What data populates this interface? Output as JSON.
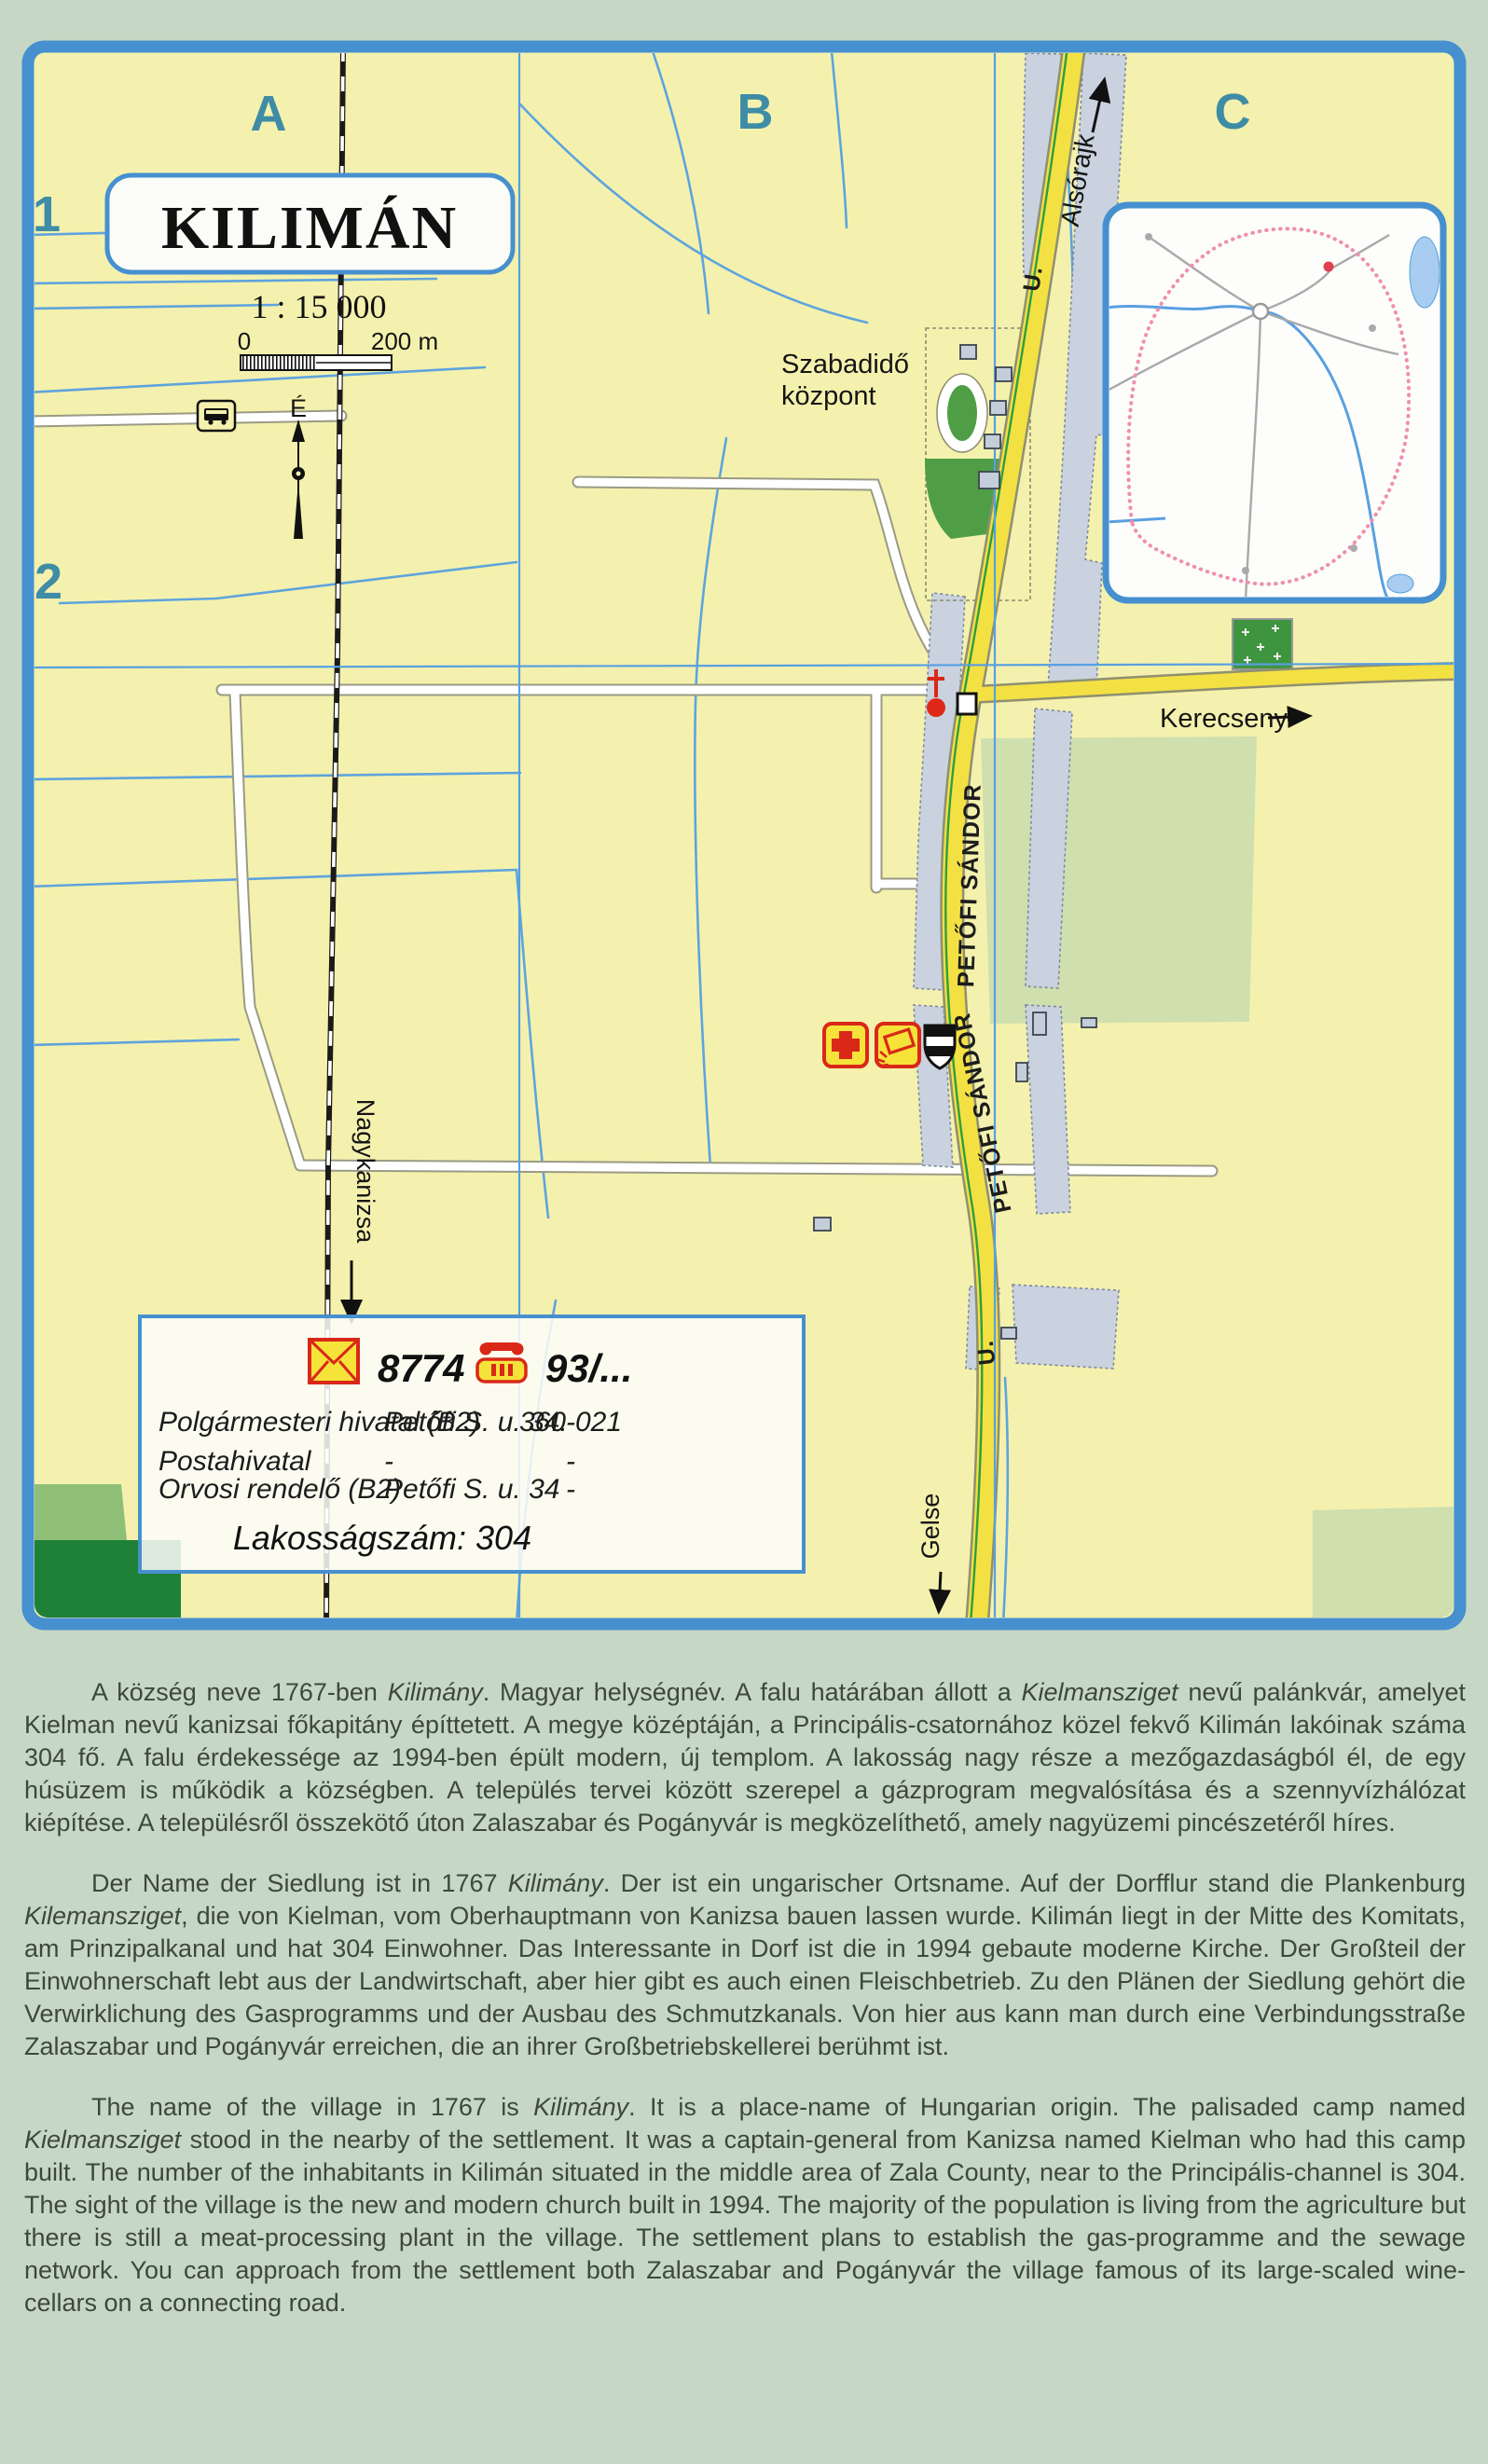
{
  "map": {
    "title": "KILIMÁN",
    "scale_text": "1 : 15 000",
    "scale_bar": {
      "start": "0",
      "end": "200 m"
    },
    "north_label": "É",
    "grid_cols": [
      "A",
      "B",
      "C"
    ],
    "grid_rows": [
      "1",
      "2"
    ],
    "labels": {
      "alsorajk": "Alsórajk",
      "kerecseny": "Kerecseny",
      "gelse": "Gelse",
      "nagykanizsa": "Nagykanizsa",
      "szabadido_line1": "Szabadidő",
      "szabadido_line2": "központ",
      "street": "PETŐFI SÁNDOR",
      "street_suffix": "U."
    },
    "icons": {
      "church": "church-icon",
      "medical": "red-cross-icon",
      "post": "posthorn-icon",
      "municipal": "shield-icon",
      "station": "bus-stop-icon",
      "cemetery": "cemetery-crosses",
      "north": "compass-needle-icon"
    }
  },
  "legend": {
    "postal_code": "8774",
    "phone_prefix": "93/...",
    "rows": [
      {
        "name": "Polgármesteri hivatal (B2)",
        "address": "Petőfi S. u. 34.",
        "phone": "360-021"
      },
      {
        "name": "Postahivatal",
        "address": "-",
        "phone": "-"
      },
      {
        "name": "Orvosi rendelő (B2)",
        "address": "Petőfi S. u. 34",
        "phone": "-"
      }
    ],
    "population_label": "Lakosságszám: 304"
  },
  "description": {
    "paragraphs": [
      {
        "lang": "hu",
        "segments": [
          {
            "t": "A község neve 1767-ben "
          },
          {
            "t": "Kilimány",
            "i": true
          },
          {
            "t": ". Magyar helységnév. A falu határában állott a "
          },
          {
            "t": "Kielmansziget",
            "i": true
          },
          {
            "t": " nevű palánkvár, amelyet Kielman nevű kanizsai főkapitány építtetett. A megye középtáján, a Principális-csatornához közel fekvő Kilimán lakóinak száma 304 fő.  A falu érdekessége az 1994-ben épült modern, új templom. A lakosság nagy része a mezőgazdaságból él, de egy húsüzem is működik a községben. A település tervei között szerepel a gázprogram megvalósítása és a szennyvízhálózat kiépítése. A településről összekötő úton Zalaszabar és  Pogányvár is megközelíthető, amely nagyüzemi pincészetéről híres."
          }
        ]
      },
      {
        "lang": "de",
        "segments": [
          {
            "t": "Der Name der Siedlung ist in 1767 "
          },
          {
            "t": "Kilimány",
            "i": true
          },
          {
            "t": ". Der ist ein ungarischer Ortsname. Auf der Dorfflur stand die Plankenburg "
          },
          {
            "t": "Kilemansziget",
            "i": true
          },
          {
            "t": ", die von Kielman, vom Oberhauptmann von Kanizsa bauen lassen wurde. Kilimán liegt in der Mitte des Komitats, am Prinzipalkanal und hat 304 Einwohner. Das Interessante in Dorf ist die in 1994 gebaute moderne Kirche. Der Großteil der Einwohnerschaft lebt aus der Landwirtschaft, aber hier gibt es auch einen Fleischbetrieb. Zu den Plänen der Siedlung gehört die Verwirklichung des Gasprogramms und der Ausbau des Schmutzkanals. Von hier aus kann man durch eine Verbindungsstraße Zalaszabar und Pogányvár erreichen, die an ihrer Großbetriebskellerei berühmt ist."
          }
        ]
      },
      {
        "lang": "en",
        "segments": [
          {
            "t": "The name of the village in 1767 is "
          },
          {
            "t": "Kilimány",
            "i": true
          },
          {
            "t": ". It is a place-name of Hungarian origin. The palisaded camp named "
          },
          {
            "t": "Kielmansziget",
            "i": true
          },
          {
            "t": " stood in the nearby of the settlement. It was a captain-general from Kanizsa named Kielman who had this camp built. The number of the inhabitants in Kilimán situated in the middle area of Zala County, near to the Principális-channel is 304. The sight of the village is the new and modern church built in 1994. The majority of the population is living from the agriculture but there is still a meat-processing plant in the village. The settlement plans to establish the gas-programme and the sewage network. You can approach from the settlement both Zalaszabar and Pogányvár the village famous of its large-scaled wine-cellars on a connecting road."
          }
        ]
      }
    ]
  },
  "colors": {
    "page_bg": "#c6d8c5",
    "map_bg": "#f4f1ae",
    "border_blue": "#4690d0",
    "road_yellow": "#f3e143",
    "builtup_gray": "#c9d2de",
    "green": "#4f9e46",
    "forest_green": "#1f8038",
    "light_green": "#cfdfae",
    "stream_blue": "#5ea4dd",
    "teal_label": "#3e8ca6",
    "accent_red": "#d92818",
    "icon_yellow": "#f5e33a",
    "inset_pink": "#ef8fae",
    "text": "#3e473e"
  }
}
